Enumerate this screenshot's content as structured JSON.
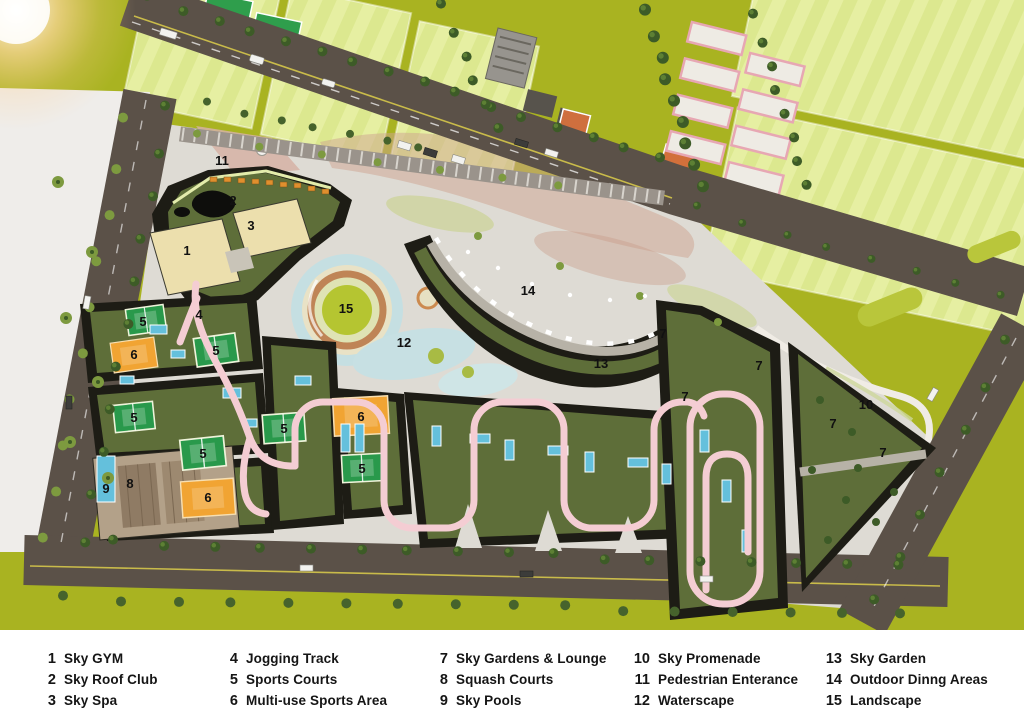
{
  "legend": {
    "items": [
      {
        "num": "1",
        "label": "Sky GYM"
      },
      {
        "num": "2",
        "label": "Sky Roof Club"
      },
      {
        "num": "3",
        "label": "Sky Spa"
      },
      {
        "num": "4",
        "label": "Jogging Track"
      },
      {
        "num": "5",
        "label": "Sports Courts"
      },
      {
        "num": "6",
        "label": "Multi-use Sports Area"
      },
      {
        "num": "7",
        "label": "Sky Gardens & Lounge"
      },
      {
        "num": "8",
        "label": "Squash Courts"
      },
      {
        "num": "9",
        "label": "Sky Pools"
      },
      {
        "num": "10",
        "label": "Sky Promenade"
      },
      {
        "num": "11",
        "label": "Pedestrian Enterance"
      },
      {
        "num": "12",
        "label": "Waterscape"
      },
      {
        "num": "13",
        "label": "Sky Garden"
      },
      {
        "num": "14",
        "label": "Outdoor Dinng Areas"
      },
      {
        "num": "15",
        "label": "Landscape"
      }
    ],
    "columns": [
      [
        0,
        1,
        2
      ],
      [
        3,
        4,
        5
      ],
      [
        6,
        7,
        8
      ],
      [
        9,
        10,
        11
      ],
      [
        12,
        13,
        14
      ]
    ]
  },
  "map": {
    "markers": [
      {
        "num": "1",
        "x": 187,
        "y": 251
      },
      {
        "num": "2",
        "x": 233,
        "y": 201
      },
      {
        "num": "3",
        "x": 251,
        "y": 226
      },
      {
        "num": "4",
        "x": 199,
        "y": 315
      },
      {
        "num": "5",
        "x": 143,
        "y": 322
      },
      {
        "num": "5",
        "x": 216,
        "y": 351
      },
      {
        "num": "5",
        "x": 134,
        "y": 418
      },
      {
        "num": "5",
        "x": 203,
        "y": 454
      },
      {
        "num": "5",
        "x": 284,
        "y": 429
      },
      {
        "num": "5",
        "x": 362,
        "y": 469
      },
      {
        "num": "6",
        "x": 134,
        "y": 355
      },
      {
        "num": "6",
        "x": 361,
        "y": 417
      },
      {
        "num": "6",
        "x": 208,
        "y": 498
      },
      {
        "num": "7",
        "x": 663,
        "y": 334
      },
      {
        "num": "7",
        "x": 759,
        "y": 366
      },
      {
        "num": "7",
        "x": 685,
        "y": 397
      },
      {
        "num": "7",
        "x": 833,
        "y": 424
      },
      {
        "num": "7",
        "x": 883,
        "y": 453
      },
      {
        "num": "8",
        "x": 130,
        "y": 484
      },
      {
        "num": "9",
        "x": 106,
        "y": 489
      },
      {
        "num": "10",
        "x": 866,
        "y": 405
      },
      {
        "num": "11",
        "x": 222,
        "y": 161
      },
      {
        "num": "12",
        "x": 404,
        "y": 343
      },
      {
        "num": "13",
        "x": 601,
        "y": 364
      },
      {
        "num": "14",
        "x": 528,
        "y": 291
      },
      {
        "num": "15",
        "x": 346,
        "y": 309
      }
    ],
    "palette": {
      "ground": "#a9b321",
      "field": "#dce88f",
      "road": "#5b5148",
      "plaza": "#dedbd4",
      "track": "#f4cdd3",
      "roofg": "#5e6e39",
      "bdark": "#1d1c15",
      "court-green": "#29994b",
      "court-orange": "#f1a433",
      "pool": "#64c0dc",
      "water": "#c5dfe2",
      "cream": "#ecdfad",
      "padel": "#e7a7b3",
      "tree": "#3d5b27",
      "marker": "#111111"
    }
  }
}
